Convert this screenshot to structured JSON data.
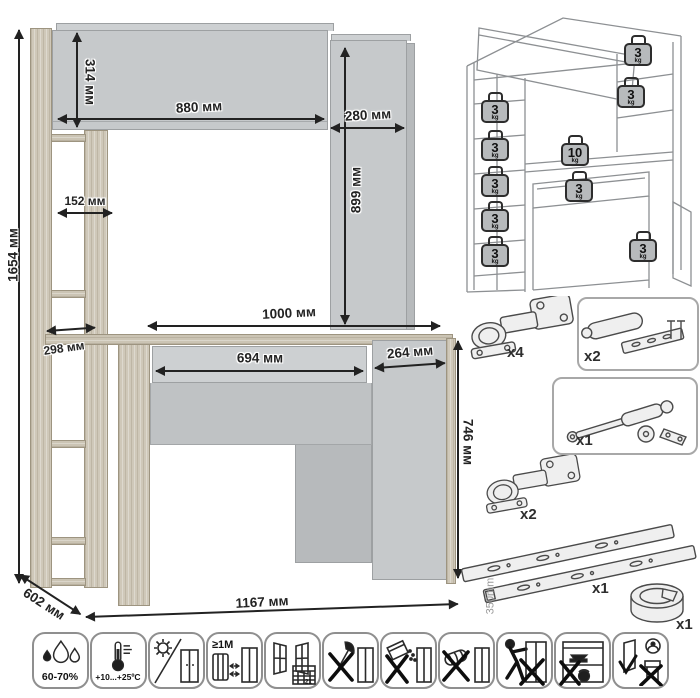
{
  "main_drawing": {
    "dimensions": {
      "total_height": "1654 мм",
      "top_cabinet_height": "314 мм",
      "top_cabinet_width": "880 мм",
      "side_column_width": "280 мм",
      "side_column_height": "899 мм",
      "upper_shelf_width": "152 мм",
      "desktop_width": "1000 мм",
      "lower_shelf_depth": "298 мм",
      "drawer_width": "694 мм",
      "cabinet_door_width": "264 мм",
      "desk_height": "746 мм",
      "depth": "602 мм",
      "total_width": "1167 мм"
    }
  },
  "load_limits": {
    "unit": "kg",
    "badges": [
      {
        "value": "3"
      },
      {
        "value": "3"
      },
      {
        "value": "3"
      },
      {
        "value": "3"
      },
      {
        "value": "3"
      },
      {
        "value": "3"
      },
      {
        "value": "3"
      },
      {
        "value": "10"
      },
      {
        "value": "3"
      },
      {
        "value": "3"
      }
    ]
  },
  "hardware": {
    "items": [
      {
        "name": "concealed-hinge",
        "qty": "x4"
      },
      {
        "name": "push-to-open-damper",
        "qty": "x2"
      },
      {
        "name": "gas-lift-strut",
        "qty": "x1"
      },
      {
        "name": "concealed-hinge",
        "qty": "x2"
      },
      {
        "name": "drawer-slides",
        "qty": "x1",
        "length": "350mm"
      },
      {
        "name": "cable-grommet",
        "qty": "x1"
      }
    ]
  },
  "care_icons": [
    {
      "name": "humidity",
      "text": "60-70%"
    },
    {
      "name": "temperature",
      "text": "+10...+25ºC"
    },
    {
      "name": "no-direct-sunlight",
      "text": ""
    },
    {
      "name": "heat-source-distance",
      "text": "≥1М"
    },
    {
      "name": "ventilation-calendar",
      "text": "21"
    },
    {
      "name": "no-sharp-tools",
      "text": ""
    },
    {
      "name": "no-abrasive-cleaners",
      "text": ""
    },
    {
      "name": "no-solvents",
      "text": ""
    },
    {
      "name": "no-dragging",
      "text": ""
    },
    {
      "name": "no-heavy-load-inside",
      "text": ""
    },
    {
      "name": "check-doors-anti-tip",
      "text": ""
    }
  ]
}
